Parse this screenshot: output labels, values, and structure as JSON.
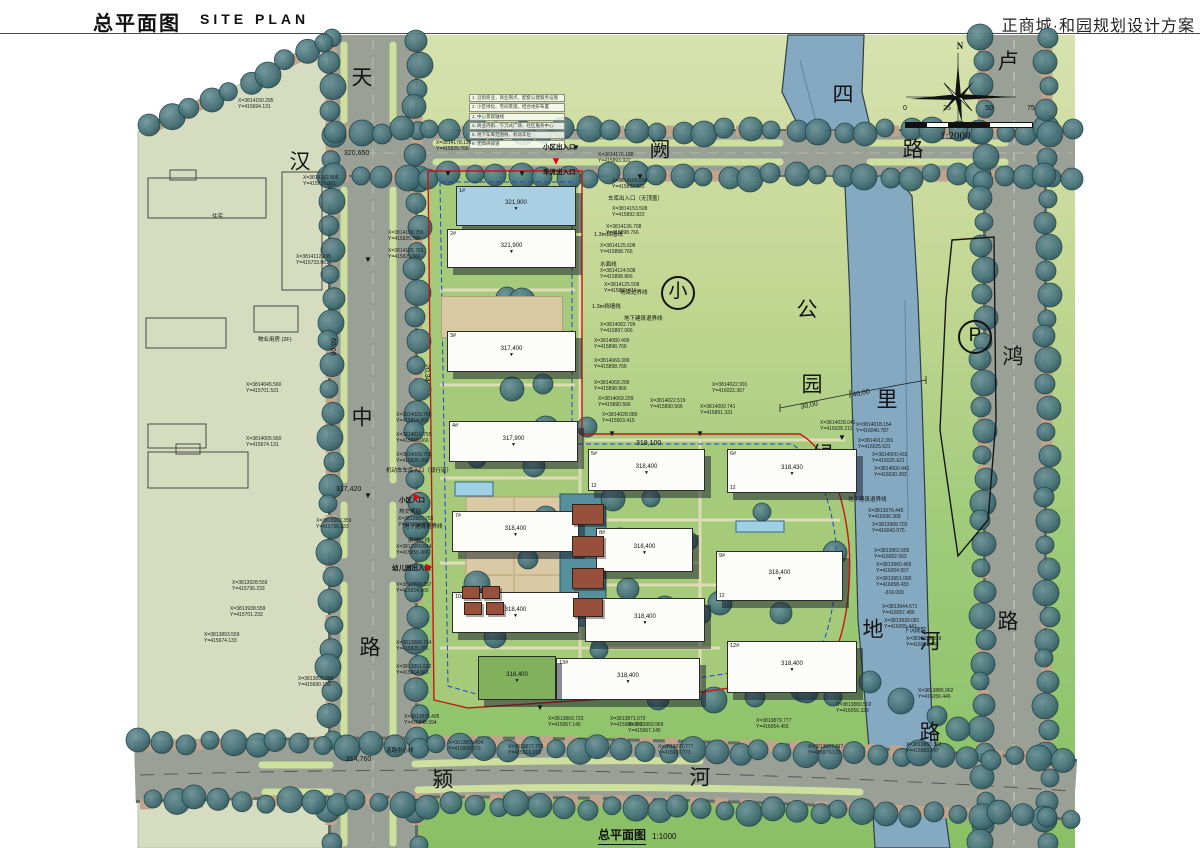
{
  "header": {
    "title_cn": "总平面图",
    "title_en": "SITE PLAN",
    "project": "正商城·和园规划设计方案"
  },
  "compass": {
    "label": "N"
  },
  "scale_bar": {
    "ticks": [
      "0",
      "25",
      "50",
      "75"
    ],
    "ratio": "1:2000"
  },
  "caption": {
    "title": "总平面图",
    "scale": "1:1000"
  },
  "road_names": [
    {
      "t": "天",
      "x": 362,
      "y": 78
    },
    {
      "t": "汉",
      "x": 300,
      "y": 162
    },
    {
      "t": "中",
      "x": 362,
      "y": 418
    },
    {
      "t": "路",
      "x": 370,
      "y": 648
    },
    {
      "t": "阙",
      "x": 660,
      "y": 150
    },
    {
      "t": "路",
      "x": 913,
      "y": 150
    },
    {
      "t": "卢",
      "x": 1008,
      "y": 62
    },
    {
      "t": "鸿",
      "x": 1013,
      "y": 357
    },
    {
      "t": "路",
      "x": 1008,
      "y": 622
    },
    {
      "t": "颍",
      "x": 443,
      "y": 780
    },
    {
      "t": "河",
      "x": 700,
      "y": 778
    },
    {
      "t": "路",
      "x": 930,
      "y": 733
    }
  ],
  "river_chars": [
    {
      "t": "四",
      "x": 843,
      "y": 95
    },
    {
      "t": "里",
      "x": 887,
      "y": 400
    },
    {
      "t": "河",
      "x": 930,
      "y": 642
    }
  ],
  "park_chars": [
    {
      "t": "公",
      "x": 807,
      "y": 310
    },
    {
      "t": "园",
      "x": 812,
      "y": 385
    },
    {
      "t": "绿",
      "x": 823,
      "y": 455
    },
    {
      "t": "地",
      "x": 873,
      "y": 630
    }
  ],
  "circled_marks": [
    {
      "t": "小",
      "x": 678,
      "y": 293,
      "name": "park-mark"
    },
    {
      "t": "P",
      "x": 975,
      "y": 337,
      "name": "parking-mark"
    }
  ],
  "notes_lines": [
    "1. 沿街商业，商业网点，配套公建服务设施",
    "2. 小区绿化、宅间景观，结合地形布置",
    "3. 中心景观轴线",
    "4. 商业内街、下沉式广场、社区服务中心",
    "5. 地下车库范围线，机动车位",
    "6. 无障碍坡道"
  ],
  "feature_labels": [
    {
      "t": "小区出入口",
      "x": 543,
      "y": 144,
      "b": 1
    },
    {
      "t": "车流出入口",
      "x": 543,
      "y": 169,
      "b": 1
    },
    {
      "t": "车库出入口（无顶盖）",
      "x": 608,
      "y": 196,
      "b": 0
    },
    {
      "t": "水面线",
      "x": 600,
      "y": 262,
      "b": 0
    },
    {
      "t": "1.3m挡墙线",
      "x": 594,
      "y": 232,
      "b": 0
    },
    {
      "t": "1.3m挡墙线",
      "x": 592,
      "y": 304,
      "b": 0
    },
    {
      "t": "地库边界线",
      "x": 620,
      "y": 290,
      "b": 0
    },
    {
      "t": "地下建筑退界线",
      "x": 624,
      "y": 316,
      "b": 0
    },
    {
      "t": "机动车车库入口（双行道）",
      "x": 386,
      "y": 468,
      "b": 0
    },
    {
      "t": "小区入口",
      "x": 399,
      "y": 497,
      "b": 1
    },
    {
      "t": "热交换站",
      "x": 399,
      "y": 509,
      "b": 0
    },
    {
      "t": "地下建筑退界线",
      "x": 404,
      "y": 524,
      "b": 0
    },
    {
      "t": "用地红线",
      "x": 408,
      "y": 538,
      "b": 0
    },
    {
      "t": "幼儿园出入口",
      "x": 392,
      "y": 565,
      "b": 1
    },
    {
      "t": "地下建筑退界线",
      "x": 848,
      "y": 497,
      "b": 0
    },
    {
      "t": "下沉庭院",
      "x": 904,
      "y": 628,
      "b": 0
    },
    {
      "t": "道路中心线",
      "x": 386,
      "y": 748,
      "b": 0
    },
    {
      "t": "物业用房 (2F)",
      "x": 258,
      "y": 337,
      "b": 0
    },
    {
      "t": "住宅",
      "x": 212,
      "y": 214,
      "b": 0
    },
    {
      "t": "儿童活动场地 708.57m²",
      "x": 468,
      "y": 312,
      "b": 0
    }
  ],
  "dim_labels": [
    {
      "t": "320,650",
      "x": 344,
      "y": 150,
      "r": 0
    },
    {
      "t": "317,420",
      "x": 336,
      "y": 486,
      "r": 0
    },
    {
      "t": "314,760",
      "x": 346,
      "y": 756,
      "r": 0
    },
    {
      "t": "43,31",
      "x": 464,
      "y": 336,
      "r": 90
    },
    {
      "t": "15,35",
      "x": 470,
      "y": 196,
      "r": 90
    },
    {
      "t": "30,00",
      "x": 800,
      "y": 404,
      "r": -12
    },
    {
      "t": "40,00",
      "x": 852,
      "y": 392,
      "r": -12
    },
    {
      "t": "60,00",
      "x": 336,
      "y": 338,
      "r": 90
    },
    {
      "t": "20,34",
      "x": 430,
      "y": 364,
      "r": 90
    },
    {
      "t": "318,100",
      "x": 636,
      "y": 440,
      "r": 0
    }
  ],
  "coord_labels": [
    [
      238,
      98,
      "X=3814150.295",
      "Y=415694.131"
    ],
    [
      296,
      254,
      "X=3814112.295",
      "Y=415733.081"
    ],
    [
      303,
      175,
      "X=3814162.895",
      "Y=415716.081"
    ],
    [
      246,
      382,
      "X=3814045.560",
      "Y=415701.531"
    ],
    [
      246,
      436,
      "X=3814005.560",
      "Y=415674.131"
    ],
    [
      316,
      518,
      "X=3813963.359",
      "Y=415736.233"
    ],
    [
      232,
      580,
      "X=3813928.559",
      "Y=415736.233"
    ],
    [
      230,
      606,
      "X=3813938.559",
      "Y=415701.233"
    ],
    [
      204,
      632,
      "X=3813893.559",
      "Y=415674.133"
    ],
    [
      298,
      676,
      "X=3813892.559",
      "Y=415690.133"
    ],
    [
      436,
      140,
      "X=3814178.128",
      "Y=415825.766"
    ],
    [
      598,
      152,
      "X=3814176.188",
      "Y=415893.922"
    ],
    [
      612,
      178,
      "X=3814168.658",
      "Y=415892.822"
    ],
    [
      612,
      206,
      "X=3814153.508",
      "Y=415892.822"
    ],
    [
      606,
      224,
      "X=3814136.708",
      "Y=415898.766"
    ],
    [
      600,
      243,
      "X=3814125.608",
      "Y=415898.766"
    ],
    [
      600,
      268,
      "X=3814124.508",
      "Y=415898.866"
    ],
    [
      604,
      282,
      "X=3814125.508",
      "Y=415890.616"
    ],
    [
      600,
      322,
      "X=3814082.799",
      "Y=415897.066"
    ],
    [
      594,
      338,
      "X=3814080.499",
      "Y=415898.766"
    ],
    [
      594,
      358,
      "X=3814069.399",
      "Y=415898.766"
    ],
    [
      594,
      380,
      "X=3814068.299",
      "Y=415898.866"
    ],
    [
      598,
      396,
      "X=3814069.299",
      "Y=415890.566"
    ],
    [
      602,
      412,
      "X=3814028.080",
      "Y=415903.415"
    ],
    [
      650,
      398,
      "X=3814022.519",
      "Y=415890.566"
    ],
    [
      712,
      382,
      "X=3814022.991",
      "Y=416022.367"
    ],
    [
      700,
      404,
      "X=3814000.741",
      "Y=415891.331"
    ],
    [
      388,
      230,
      "X=3814136.755",
      "Y=415825.766"
    ],
    [
      388,
      248,
      "X=3814125.755",
      "Y=415825.566"
    ],
    [
      396,
      412,
      "X=3814020.755",
      "Y=415814.966"
    ],
    [
      396,
      432,
      "X=3814016.755",
      "Y=415815.066"
    ],
    [
      396,
      452,
      "X=3814009.755",
      "Y=415825.066"
    ],
    [
      398,
      516,
      "X=3813965.755",
      "Y=415854.066"
    ],
    [
      396,
      544,
      "X=3813960.644",
      "Y=415855.066"
    ],
    [
      396,
      582,
      "X=3813939.337",
      "Y=415814.966"
    ],
    [
      396,
      640,
      "X=3813889.714",
      "Y=415825.766"
    ],
    [
      396,
      664,
      "X=3813891.522",
      "Y=415814.966"
    ],
    [
      820,
      420,
      "X=3814028.041",
      "Y=416028.211"
    ],
    [
      856,
      422,
      "X=3814018.154",
      "Y=416040.787"
    ],
    [
      858,
      438,
      "X=3814012.391",
      "Y=416025.621"
    ],
    [
      872,
      452,
      "X=3814000.433",
      "Y=416025.621"
    ],
    [
      874,
      466,
      "X=3814000.441",
      "Y=416030.282"
    ],
    [
      868,
      508,
      "X=3813976.445",
      "Y=416036.368"
    ],
    [
      872,
      522,
      "X=3813989.703",
      "Y=416043.075"
    ],
    [
      874,
      548,
      "X=3813962.655",
      "Y=416052.063"
    ],
    [
      876,
      562,
      "X=3813960.465",
      "Y=416054.557"
    ],
    [
      876,
      576,
      "X=3813951.090",
      "Y=416058.433"
    ],
    [
      884,
      590,
      "-316.000",
      ""
    ],
    [
      882,
      604,
      "X=3813944.571",
      "Y=416057.485"
    ],
    [
      884,
      618,
      "X=3813939.081",
      "Y=416055.441"
    ],
    [
      906,
      636,
      "X=3813938.839",
      "Y=416054.445"
    ],
    [
      404,
      714,
      "X=3813875.495",
      "Y=415848.594"
    ],
    [
      448,
      740,
      "X=3813875.494",
      "Y=415900.573"
    ],
    [
      508,
      744,
      "X=3813877.773",
      "Y=415913.973"
    ],
    [
      548,
      716,
      "X=3813869.723",
      "Y=415967.145"
    ],
    [
      610,
      716,
      "X=3813871.670",
      "Y=415966.000"
    ],
    [
      658,
      744,
      "X=3813877.777",
      "Y=415937.773"
    ],
    [
      628,
      722,
      "X=3813969.969",
      "Y=415967.145"
    ],
    [
      756,
      718,
      "X=3813879.777",
      "Y=416054.455"
    ],
    [
      808,
      744,
      "X=3813877.777",
      "Y=415973.173"
    ],
    [
      836,
      702,
      "X=3813880.502",
      "Y=416056.329"
    ],
    [
      906,
      742,
      "X=3813880.392",
      "Y=415983.147"
    ],
    [
      918,
      688,
      "X=3813886.962",
      "Y=416056.446"
    ]
  ],
  "buildings": [
    {
      "x": 456,
      "y": 186,
      "w": 118,
      "h": 38,
      "num": "1#",
      "elev": "321,900",
      "color": "blue",
      "flr": ""
    },
    {
      "x": 447,
      "y": 229,
      "w": 127,
      "h": 37,
      "num": "2#",
      "elev": "321,900",
      "color": "white",
      "flr": ""
    },
    {
      "x": 441,
      "y": 296,
      "w": 120,
      "h": 40,
      "num": "",
      "elev": "",
      "color": "tan",
      "flr": ""
    },
    {
      "x": 447,
      "y": 331,
      "w": 127,
      "h": 39,
      "num": "3#",
      "elev": "317,400",
      "color": "white",
      "flr": ""
    },
    {
      "x": 449,
      "y": 421,
      "w": 127,
      "h": 39,
      "num": "4#",
      "elev": "317,900",
      "color": "white",
      "flr": ""
    },
    {
      "x": 452,
      "y": 511,
      "w": 125,
      "h": 39,
      "num": "7#",
      "elev": "318,400",
      "color": "white",
      "flr": ""
    },
    {
      "x": 452,
      "y": 592,
      "w": 125,
      "h": 39,
      "num": "10#",
      "elev": "318,400",
      "color": "white",
      "flr": ""
    },
    {
      "x": 588,
      "y": 449,
      "w": 115,
      "h": 40,
      "num": "5#",
      "elev": "318,400",
      "color": "white",
      "flr": "12"
    },
    {
      "x": 596,
      "y": 528,
      "w": 95,
      "h": 42,
      "num": "8#",
      "elev": "318,400",
      "color": "white",
      "flr": ""
    },
    {
      "x": 585,
      "y": 598,
      "w": 118,
      "h": 42,
      "num": "11#",
      "elev": "318,400",
      "color": "white",
      "flr": ""
    },
    {
      "x": 727,
      "y": 449,
      "w": 128,
      "h": 42,
      "num": "6#",
      "elev": "318,430",
      "color": "white",
      "flr": "12"
    },
    {
      "x": 716,
      "y": 551,
      "w": 125,
      "h": 48,
      "num": "9#",
      "elev": "318,400",
      "color": "white",
      "flr": "12"
    },
    {
      "x": 727,
      "y": 641,
      "w": 128,
      "h": 50,
      "num": "12#",
      "elev": "318,400",
      "color": "white",
      "flr": ""
    },
    {
      "x": 556,
      "y": 658,
      "w": 142,
      "h": 40,
      "num": "13#",
      "elev": "318,400",
      "color": "white",
      "flr": ""
    },
    {
      "x": 478,
      "y": 656,
      "w": 76,
      "h": 42,
      "num": "",
      "elev": "318,400",
      "color": "green",
      "flr": ""
    }
  ],
  "markers": [
    {
      "x": 556,
      "y": 162,
      "t": "▼",
      "c": "#e00000",
      "s": 11
    },
    {
      "x": 417,
      "y": 497,
      "t": "▶",
      "c": "#e00000",
      "s": 9
    },
    {
      "x": 429,
      "y": 567,
      "t": "▶",
      "c": "#e00000",
      "s": 9
    },
    {
      "x": 448,
      "y": 174,
      "t": "▼",
      "c": "#111",
      "s": 8
    },
    {
      "x": 522,
      "y": 174,
      "t": "▼",
      "c": "#111",
      "s": 8
    },
    {
      "x": 576,
      "y": 148,
      "t": "▼",
      "c": "#111",
      "s": 8
    },
    {
      "x": 640,
      "y": 177,
      "t": "▼",
      "c": "#111",
      "s": 8
    },
    {
      "x": 368,
      "y": 260,
      "t": "▼",
      "c": "#111",
      "s": 8
    },
    {
      "x": 368,
      "y": 496,
      "t": "▼",
      "c": "#111",
      "s": 8
    },
    {
      "x": 540,
      "y": 708,
      "t": "▼",
      "c": "#111",
      "s": 8
    },
    {
      "x": 612,
      "y": 434,
      "t": "▼",
      "c": "#111",
      "s": 8
    },
    {
      "x": 700,
      "y": 434,
      "t": "▼",
      "c": "#111",
      "s": 8
    },
    {
      "x": 842,
      "y": 438,
      "t": "▼",
      "c": "#111",
      "s": 8
    }
  ]
}
